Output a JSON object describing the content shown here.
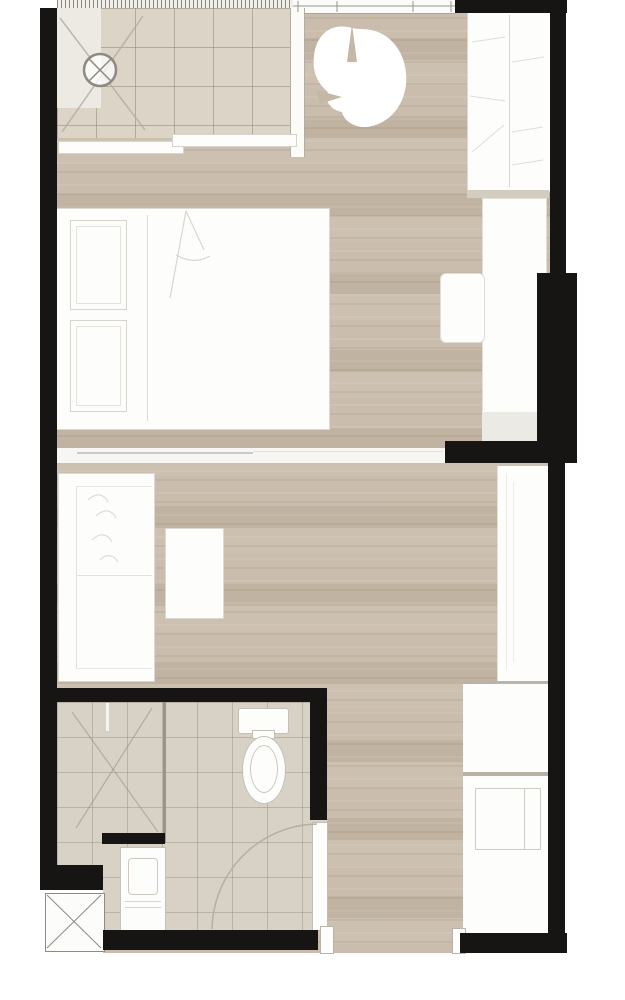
{
  "document": {
    "kind": "architectural-floor-plan",
    "description": "Top-down floor plan of a studio apartment unit, no text labels rendered"
  },
  "colors": {
    "background": "#ffffff",
    "wall": "#161513",
    "floor_wood": "#c8bbaa",
    "tile_balcony": "#dcd4c6",
    "tile_bathroom": "#d8d1c5",
    "furniture_fill": "#fdfdfb",
    "furniture_line": "#d7d4cd",
    "sketch_line": "#dedbd4",
    "shadow": "#d2ccc1",
    "partition": "#f7f6f2",
    "grille": "#8b887f"
  },
  "rooms": [
    {
      "name": "balcony",
      "floor": "tile",
      "features": [
        "floor-drain",
        "condenser-cross-marks",
        "sliding-glass-door"
      ]
    },
    {
      "name": "bedroom",
      "floor": "wood",
      "features": [
        "double-bed",
        "pillows",
        "wardrobe",
        "desk-counter",
        "stool",
        "potted-plant"
      ]
    },
    {
      "name": "living-area",
      "floor": "wood",
      "features": [
        "sofa",
        "coffee-table",
        "kitchen-counter"
      ]
    },
    {
      "name": "bathroom",
      "floor": "tile",
      "features": [
        "shower-zone",
        "toilet",
        "vanity-sink",
        "swing-door"
      ]
    },
    {
      "name": "hallway-entrance",
      "floor": "wood",
      "features": [
        "kitchen-counter-upper",
        "kitchen-counter-lower",
        "appliance",
        "entrance-opening",
        "service-shaft"
      ]
    }
  ],
  "fixtures": [
    "floor-drain",
    "sliding-door-panel-left",
    "sliding-door-panel-right",
    "plant",
    "wardrobe",
    "desk-counter",
    "stool",
    "bed",
    "pillow",
    "bedroom-living-partition",
    "sofa",
    "coffee-table",
    "kitchen-counter",
    "counter-upper",
    "counter-lower",
    "appliance",
    "toilet",
    "shower-divider",
    "vanity-sink",
    "bathroom-door",
    "door-swing-arc",
    "service-shaft",
    "entrance-jamb"
  ]
}
